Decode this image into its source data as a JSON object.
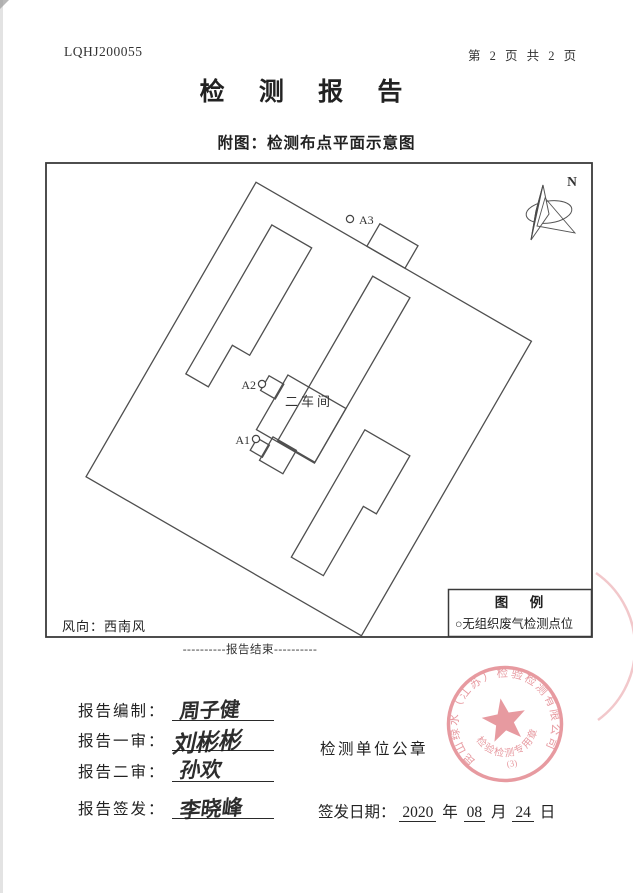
{
  "colors": {
    "seal": "#e2848c",
    "ink": "#2b2b2b",
    "line": "#4f4f4f"
  },
  "header": {
    "report_no": "LQHJ200055",
    "page_indicator": "第 2 页 共 2 页",
    "title": "检 测 报 告",
    "subtitle": "附图：检测布点平面示意图"
  },
  "diagram": {
    "north_label": "N",
    "workshop_label": "二车间",
    "wind_note": "风向：西南风",
    "points": [
      {
        "id": "A1"
      },
      {
        "id": "A2"
      },
      {
        "id": "A3"
      }
    ],
    "legend": {
      "title": "图　例",
      "item": "○无组织废气检测点位"
    }
  },
  "footer": {
    "end_marker": "----------报告结束----------"
  },
  "signoff": {
    "rows": [
      {
        "label": "报告编制：",
        "name": "周子健"
      },
      {
        "label": "报告一审：",
        "name": "刘彬彬"
      },
      {
        "label": "报告二审：",
        "name": "孙欢"
      },
      {
        "label": "报告签发：",
        "name": "李晓峰"
      }
    ],
    "seal_caption": "检测单位公章",
    "date": {
      "label": "签发日期：",
      "year": "2020",
      "year_unit": "年",
      "month": "08",
      "month_unit": "月",
      "day": "24",
      "day_unit": "日"
    }
  },
  "seal": {
    "ring_text": "昆山绿水（江苏）检验检测有限公司",
    "type_text": "检验检测专用章",
    "number": "(3)"
  }
}
